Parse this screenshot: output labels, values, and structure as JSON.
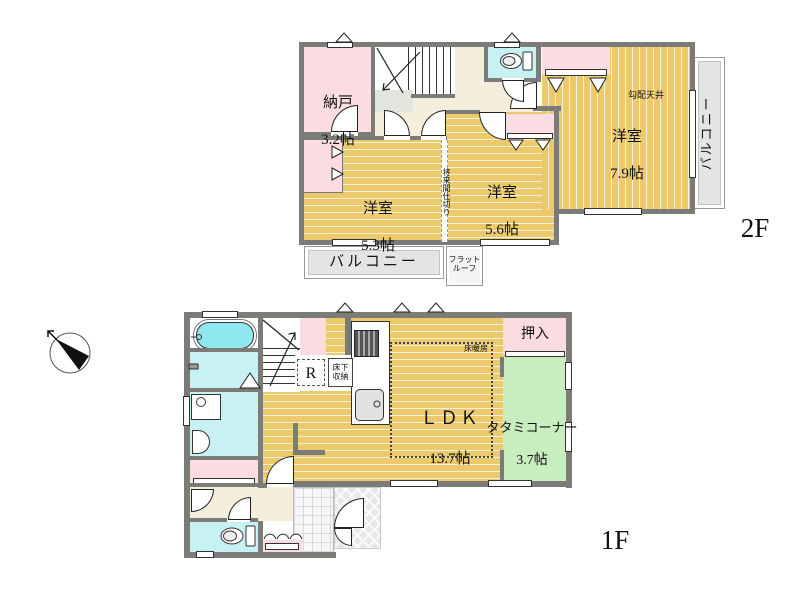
{
  "floor2": {
    "label": "2F",
    "rooms": {
      "nando": {
        "name": "納戸",
        "size": "3.2帖"
      },
      "west_bedroom": {
        "name": "洋室",
        "size": "5.3帖"
      },
      "center_bedroom": {
        "name": "洋室",
        "size": "5.6帖"
      },
      "east_bedroom": {
        "name": "洋室",
        "size": "7.9帖"
      }
    },
    "sloped_ceiling": "勾配天井",
    "future_partition": "将来間仕切り",
    "balcony_bottom": "バルコニー",
    "balcony_right": "バルコニー",
    "flat_roof": "フラット\nルーフ"
  },
  "floor1": {
    "label": "1F",
    "rooms": {
      "ldk": {
        "name": "ＬＤＫ",
        "size": "13.7帖"
      },
      "tatami": {
        "name": "タタミコーナー",
        "size": "3.7帖"
      },
      "oshiire": "押入"
    },
    "floor_heating": "床暖房",
    "refrigerator": "R",
    "underfloor_storage": "床下\n収納"
  },
  "colors": {
    "wall": "#7b7b77",
    "wood": "#ecca6b",
    "woodline": "#f9f1da",
    "pink": "#fbdce1",
    "cyan": "#c8f1f3",
    "tub": "#8fe8ee",
    "beige": "#f5eedc",
    "green": "#c8edbe",
    "balc": "#e4e4e2",
    "ink": "#111111"
  }
}
